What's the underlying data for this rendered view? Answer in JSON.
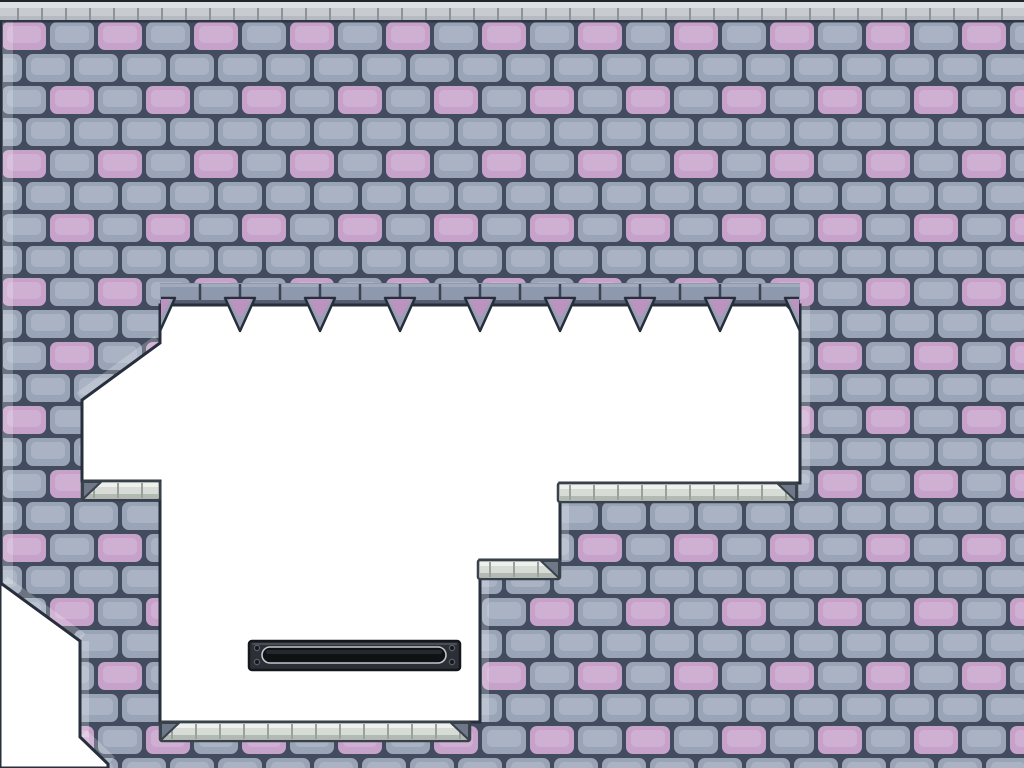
{
  "scene": {
    "name": "castle-brick-platformer-level",
    "width": 1024,
    "height": 768,
    "background": "#ffffff"
  },
  "colors": {
    "mortar": "#434c5e",
    "brick_gray": "#99a4b7",
    "brick_gray_light": "#b5bfcc",
    "brick_pink": "#c6a1c9",
    "brick_pink_light": "#d7b9d9",
    "outline": "#272e3c",
    "band_fill": "#8f99ad",
    "band_top": "#a6afc0",
    "band_joint": "#3a4150",
    "band_lip": "#555d71",
    "spike_gray": "#98a1b3",
    "spike_pink": "#bc92bf",
    "stone_fill": "#d8dcd7",
    "stone_top": "#eef0ec",
    "stone_shadow": "#b3bab3",
    "stone_joint": "#99a19b",
    "stone_outline": "#39414b",
    "bevel": "#6f7888",
    "strip_dark": "#20252c",
    "strip_light": "#dde1e4",
    "strip_seg": "#c7ccd1",
    "strip_seg_shadow": "#a9afb5",
    "strip_joint": "#8c9399",
    "under_strip": "#2b3240",
    "door_frame": "#2c3036",
    "door_edge": "#14171b",
    "door_top": "#4d525a",
    "door_slot": "#0f1215",
    "door_ring": "#c2c7cb",
    "screw": "#14171b",
    "screw_ring": "#5a6069",
    "edge_highlight": "#ffffff"
  },
  "brick_tile": {
    "w": 96,
    "h": 128,
    "row_h": 32,
    "brick_w": 48,
    "gap_x": 4,
    "gap_y": 4,
    "radius": 7,
    "pattern_y": 20,
    "rows": [
      {
        "offset": 0,
        "pink_cols": [
          0
        ]
      },
      {
        "offset": 24,
        "pink_cols": []
      },
      {
        "offset": 0,
        "pink_cols": [
          1
        ]
      },
      {
        "offset": 24,
        "pink_cols": []
      }
    ]
  },
  "wall": {
    "outer": [
      [
        0,
        0
      ],
      [
        1024,
        0
      ],
      [
        1024,
        768
      ],
      [
        0,
        768
      ]
    ],
    "holes": [
      [
        [
          160,
          305
        ],
        [
          800,
          305
        ],
        [
          800,
          483
        ],
        [
          560,
          483
        ],
        [
          560,
          560
        ],
        [
          480,
          560
        ],
        [
          480,
          722
        ],
        [
          160,
          722
        ],
        [
          160,
          481
        ],
        [
          82,
          481
        ],
        [
          82,
          400
        ],
        [
          160,
          343
        ]
      ],
      [
        [
          2,
          584
        ],
        [
          80,
          641
        ],
        [
          80,
          737
        ],
        [
          108,
          764
        ],
        [
          108,
          768
        ],
        [
          0,
          768
        ],
        [
          0,
          584
        ]
      ]
    ]
  },
  "ceiling_band": {
    "x": 160,
    "y": 283,
    "w": 640,
    "h": 22,
    "block_w": 40
  },
  "spikes": {
    "base_y": 298,
    "tip_y": 331,
    "half_w": 15,
    "centers": [
      160,
      240,
      320,
      400,
      480,
      560,
      640,
      720,
      800
    ],
    "corner_bevel_right": [
      [
        786,
        305
      ],
      [
        800,
        305
      ],
      [
        800,
        320
      ]
    ],
    "clip": {
      "x": 161,
      "y": 283,
      "w": 638,
      "h": 52
    }
  },
  "top_strip": {
    "x": 0,
    "w": 1024,
    "joint_phase": 18,
    "joint_step": 24
  },
  "ledges": [
    {
      "x": 82,
      "y": 481,
      "w": 78,
      "h": 19,
      "bevel": "left"
    },
    {
      "x": 558,
      "y": 483,
      "w": 239,
      "h": 19,
      "bevel": "right"
    },
    {
      "x": 478,
      "y": 560,
      "w": 82,
      "h": 19,
      "bevel": "right"
    },
    {
      "x": 160,
      "y": 722,
      "w": 310,
      "h": 19,
      "bevel": "both"
    }
  ],
  "edge_highlights": {
    "opacity": 0.22,
    "rects": [
      [
        2,
        20,
        11,
        564
      ],
      [
        800,
        306,
        10,
        177
      ],
      [
        560,
        484,
        9,
        76
      ],
      [
        480,
        561,
        9,
        161
      ],
      [
        80,
        641,
        9,
        96
      ]
    ],
    "lines": [
      [
        157,
        339,
        79,
        396,
        8
      ],
      [
        5,
        580,
        83,
        637,
        8
      ],
      [
        84,
        733,
        112,
        760,
        8
      ]
    ]
  },
  "door": {
    "x": 249,
    "y": 641,
    "w": 211,
    "h": 29,
    "radius": 3,
    "slot": {
      "x": 262,
      "y": 647,
      "w": 184,
      "h": 16,
      "radius": 8
    },
    "screws": [
      [
        257,
        648
      ],
      [
        257,
        662
      ],
      [
        452,
        648
      ],
      [
        452,
        662
      ]
    ],
    "screw_r": 2.6
  }
}
